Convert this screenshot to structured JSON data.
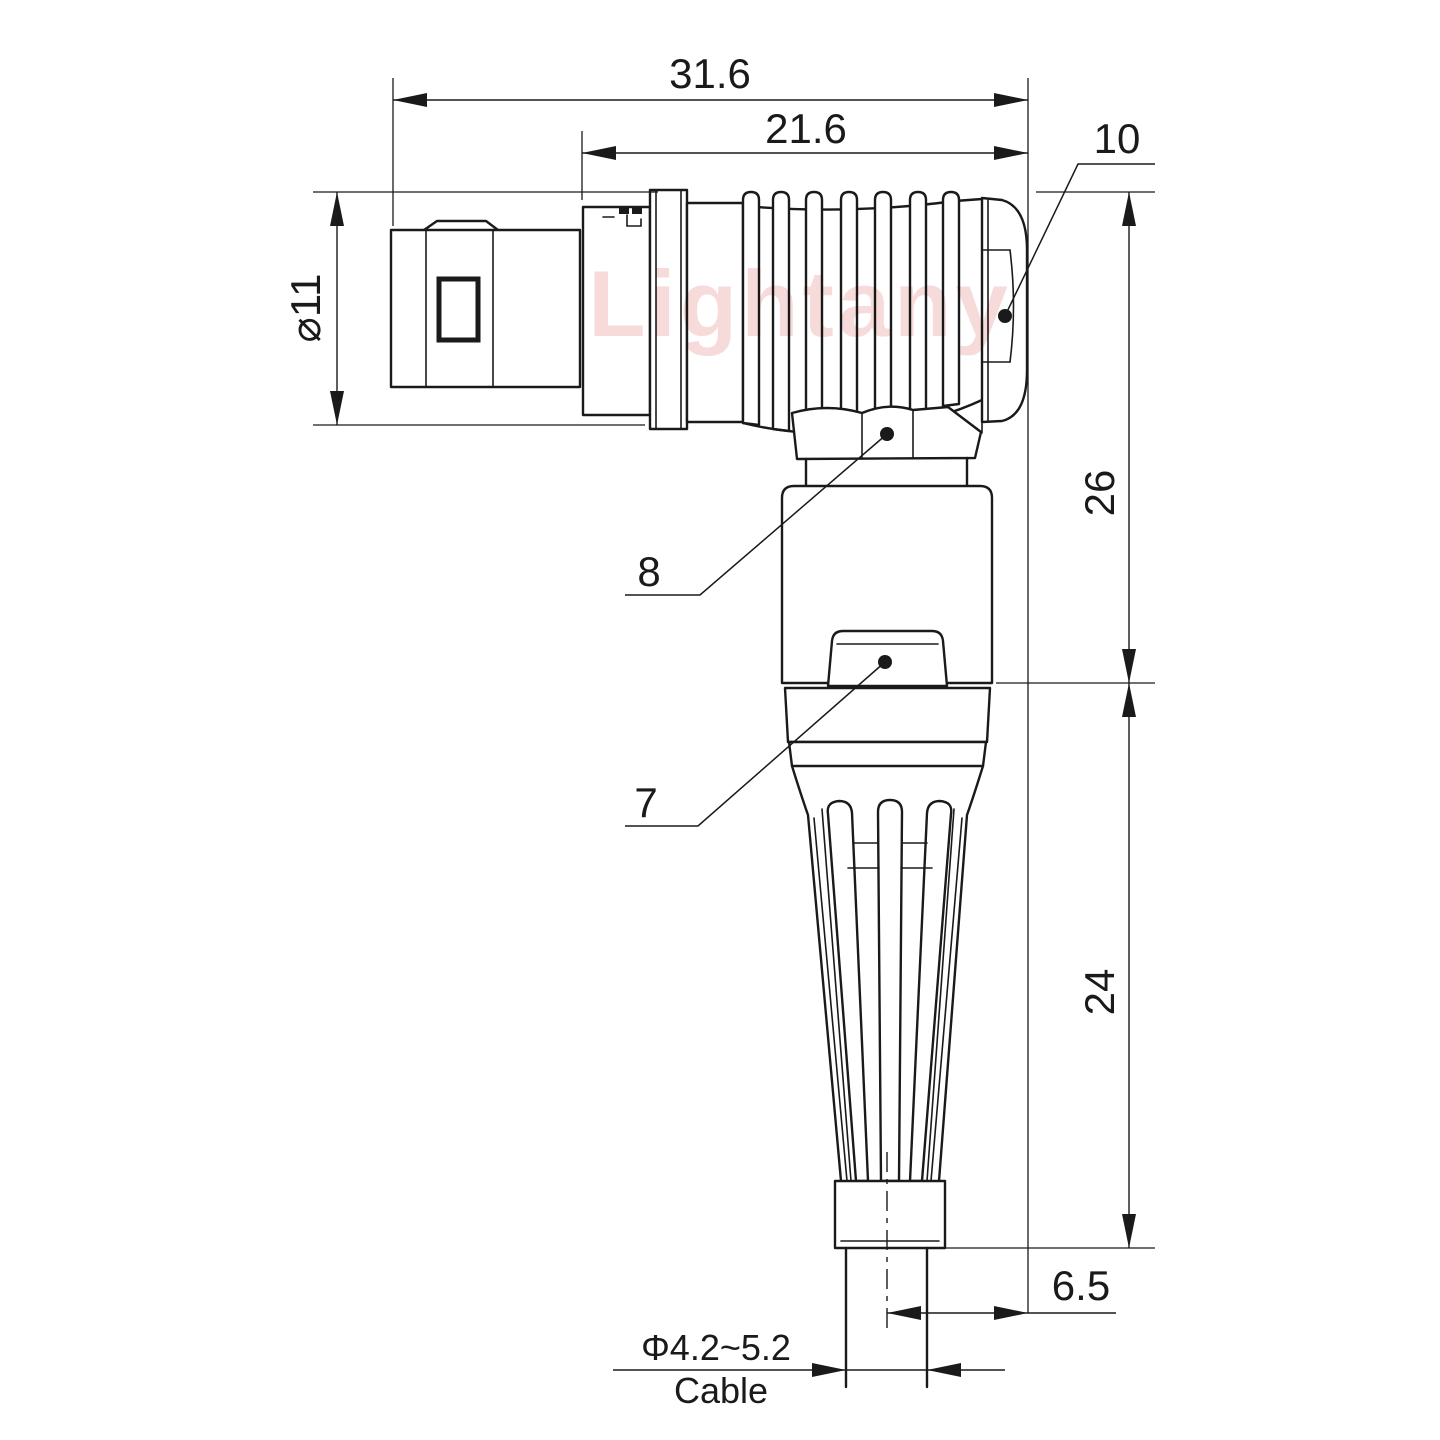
{
  "watermark": "Lightany",
  "dims": {
    "overall": "31.6",
    "body": "21.6",
    "diameter": "⌀11",
    "upper_right": "26",
    "lower_right": "24",
    "rear_offset": "6.5",
    "cable_diameter": "Φ4.2~5.2",
    "cable": "Cable"
  },
  "part_labels": {
    "coupling_nut": "10",
    "elbow_hex_nut": "8",
    "housing_latch": "7"
  },
  "colors": {
    "line": "#1a1a1a",
    "watermark_pink": "#f0b8b8",
    "background": "#ffffff"
  }
}
